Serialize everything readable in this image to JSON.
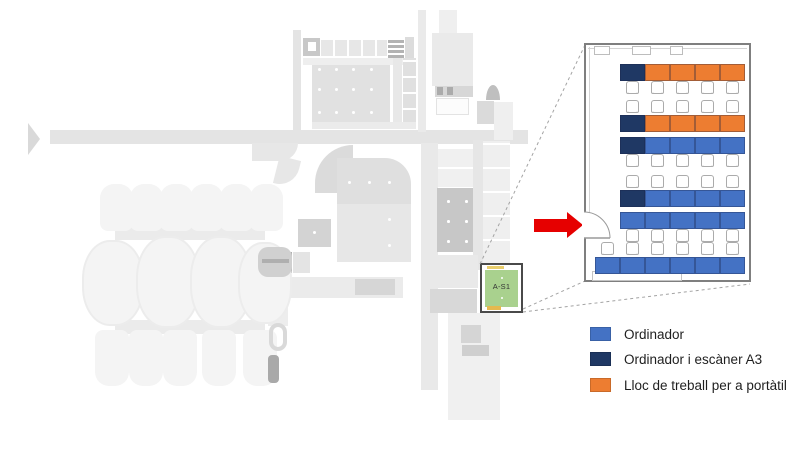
{
  "plan": {
    "highlight_room_label": "A-S1",
    "highlight_room_fill": "#A9D18E"
  },
  "colors": {
    "blue": "#4472C4",
    "navy": "#1F3864",
    "orange": "#ED7D31",
    "arrow_red": "#E60000"
  },
  "detail_room": {
    "rows": [
      {
        "chairs": "below",
        "desks": [
          "navy",
          "orange",
          "orange",
          "orange",
          "orange"
        ]
      },
      {
        "chairs": "above",
        "desks": [
          "navy",
          "orange",
          "orange",
          "orange",
          "orange"
        ]
      },
      {
        "chairs": "below",
        "desks": [
          "navy",
          "blue",
          "blue",
          "blue",
          "blue"
        ]
      },
      {
        "chairs": "above",
        "desks": [
          "navy",
          "blue",
          "blue",
          "blue",
          "blue"
        ]
      },
      {
        "chairs": "below",
        "desks": [
          "blue",
          "blue",
          "blue",
          "blue",
          "blue"
        ]
      },
      {
        "chairs": "above",
        "desks": [
          "blue",
          "blue",
          "blue",
          "blue",
          "blue",
          "blue"
        ]
      }
    ]
  },
  "legend": {
    "items": [
      {
        "label": "Ordinador",
        "color": "#4472C4"
      },
      {
        "label": "Ordinador i escàner A3",
        "color": "#1F3864"
      },
      {
        "label": "Lloc de treball per a portàtil",
        "color": "#ED7D31"
      }
    ]
  }
}
